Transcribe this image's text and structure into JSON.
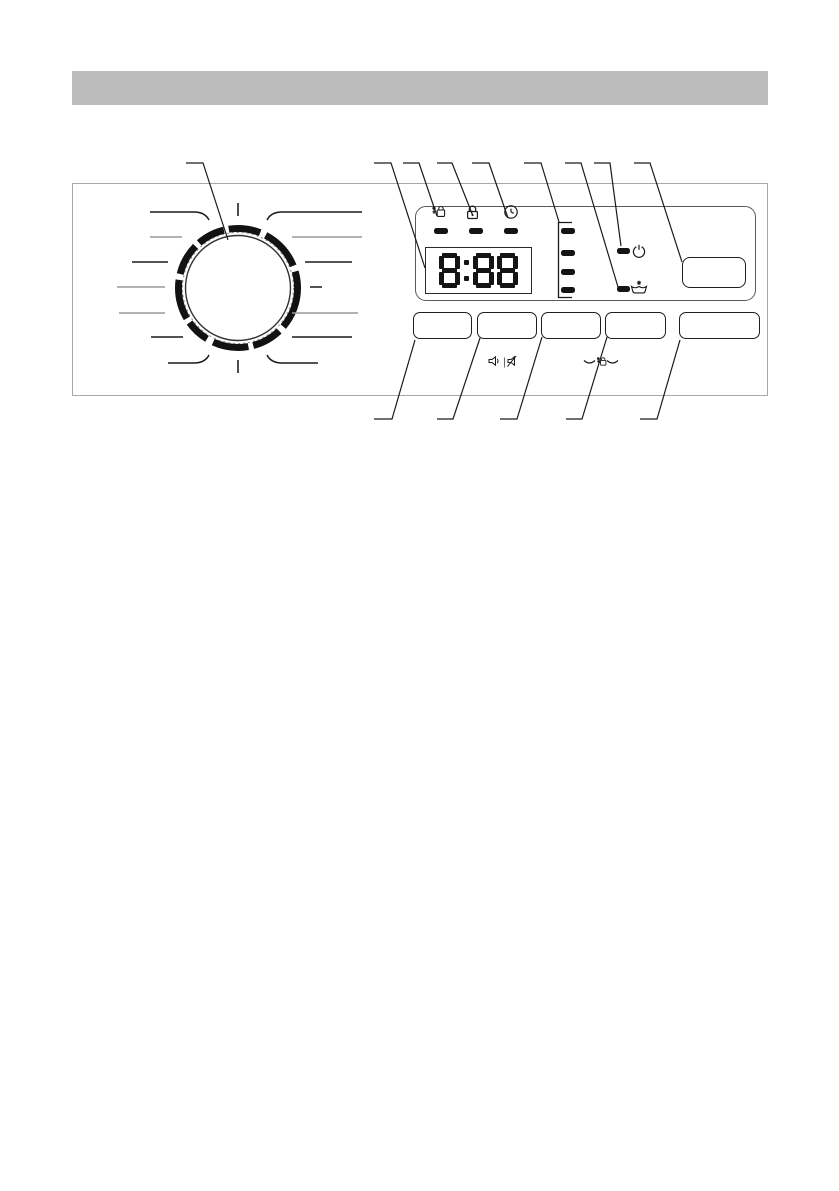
{
  "header": {
    "bar_color": "#bcbcbc"
  },
  "control_panel": {
    "display": {
      "value": "8:88"
    },
    "top_indicators": [
      {
        "icon": "child-lock-icon"
      },
      {
        "icon": "door-locked-icon"
      },
      {
        "icon": "delay-start-icon"
      }
    ],
    "phase_indicator": {
      "led_count": 4
    },
    "side_indicators": [
      {
        "icon": "power-standby-icon"
      },
      {
        "icon": "tub-star-icon"
      }
    ],
    "buttons": {
      "option_button_count": 4,
      "right_button_count": 1,
      "small_button_count": 1
    },
    "button_row_icons": [
      {
        "icon": "sound-on-off-icon"
      },
      {
        "icon": "child-lock-combo-icon"
      }
    ],
    "colors": {
      "line_dark": "#1a1a1a",
      "line_muted": "#9a9a9a",
      "led": "#141414",
      "panel_border": "#a8a8a8"
    }
  }
}
